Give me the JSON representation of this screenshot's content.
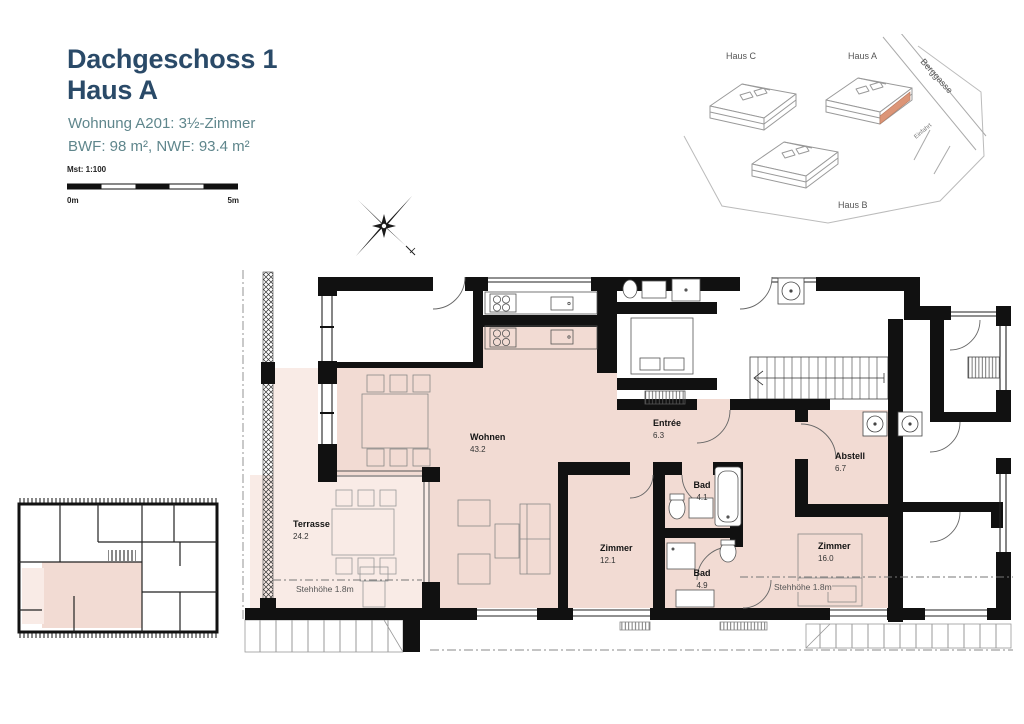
{
  "colors": {
    "title": "#2a4a68",
    "subtitle": "#5f868c",
    "apartment_fill": "#f2dbd3",
    "terrace_fill": "#f9ebe6",
    "site_highlight": "#dc9577",
    "wall": "#111111"
  },
  "header": {
    "title_line1": "Dachgeschoss 1",
    "title_line2": "Haus A",
    "subtitle": "Wohnung A201: 3½-Zimmer",
    "area_info": "BWF: 98 m², NWF: 93.4 m²"
  },
  "scale_bar": {
    "label": "Mst: 1:100",
    "start": "0m",
    "end": "5m"
  },
  "site_plan": {
    "haus_a": "Haus A",
    "haus_b": "Haus B",
    "haus_c": "Haus C",
    "street": "Berggasse",
    "driveway": "Einfahrt"
  },
  "floor_plan": {
    "rooms": {
      "wohnen": {
        "name": "Wohnen",
        "area": "43.2"
      },
      "entree": {
        "name": "Entrée",
        "area": "6.3"
      },
      "abstell": {
        "name": "Abstell",
        "area": "6.7"
      },
      "zimmer_klein": {
        "name": "Zimmer",
        "area": "12.1"
      },
      "bad_oben": {
        "name": "Bad",
        "area": "4.1"
      },
      "bad_unten": {
        "name": "Bad",
        "area": "4.9"
      },
      "zimmer_gross": {
        "name": "Zimmer",
        "area": "16.0"
      },
      "terrasse": {
        "name": "Terrasse",
        "area": "24.2"
      }
    },
    "annotations": {
      "stehhoehe_terrasse": "Stehhöhe 1.8m",
      "stehhoehe_zimmer": "Stehhöhe 1.8m"
    }
  }
}
